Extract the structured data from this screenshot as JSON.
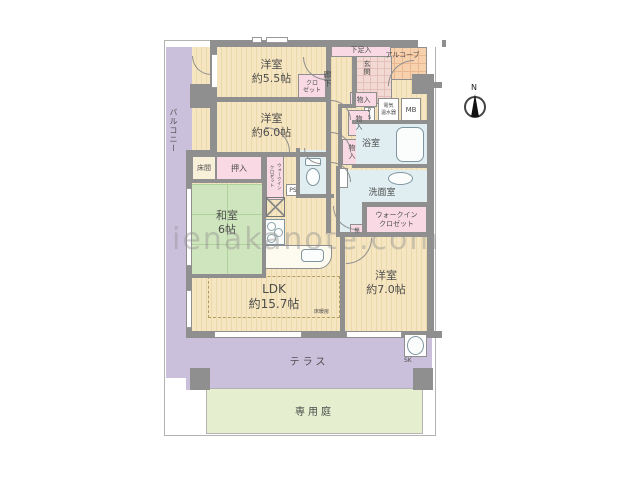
{
  "watermark": {
    "text": "ienakanote.com"
  },
  "compass": {
    "label": "N"
  },
  "colors": {
    "wall": "#8f8f8f",
    "flooring": "#f5e5c0",
    "tatami_green": "#cfe5bd",
    "closet_pink": "#f8d9e4",
    "wet_area_blue": "#e0eef1",
    "balcony_purple": "#cbc0dc",
    "garden_green": "#e5efcf",
    "alcove_orange": "#f7d0ae",
    "entrance_tile": "#f2d9d3"
  },
  "rooms": {
    "balcony": {
      "label": "バルコニー"
    },
    "bedroom55": {
      "label": "洋室\n約5.5帖"
    },
    "bedroom60": {
      "label": "洋室\n約6.0帖"
    },
    "bedroom70": {
      "label": "洋室\n約7.0帖"
    },
    "japanese_room": {
      "label": "和室\n6帖"
    },
    "ldk": {
      "label": "LDK\n約15.7帖"
    },
    "floor_heating": {
      "label": "床暖房"
    },
    "corridor": {
      "label": "廊下"
    },
    "entrance": {
      "label": "玄関"
    },
    "alcove": {
      "label": "アルコーブ"
    },
    "shoe_cabinet": {
      "label": "下足入"
    },
    "closet": {
      "label": "クロ\nゼット"
    },
    "storage1": {
      "label": "物入"
    },
    "storage2": {
      "label": "物入"
    },
    "storage3": {
      "label": "物入"
    },
    "pipe_space1": {
      "label": "PS"
    },
    "pipe_space2": {
      "label": "PS"
    },
    "water_heater": {
      "label": "電気\n温水器"
    },
    "meter_box": {
      "label": "MB"
    },
    "bathroom": {
      "label": "浴室"
    },
    "washroom": {
      "label": "洗面室"
    },
    "walk_in_closet": {
      "label": "ウォークイン\nクロゼット"
    },
    "walk_in_closet_strip": {
      "label": "ウォークイン\nクロゼット"
    },
    "shelf": {
      "label": "棚"
    },
    "tokonoma": {
      "label": "床間"
    },
    "oshiire": {
      "label": "押入"
    },
    "slop_sink": {
      "label": "SK"
    },
    "terrace": {
      "label": "テラス"
    },
    "private_garden": {
      "label": "専用庭"
    }
  }
}
